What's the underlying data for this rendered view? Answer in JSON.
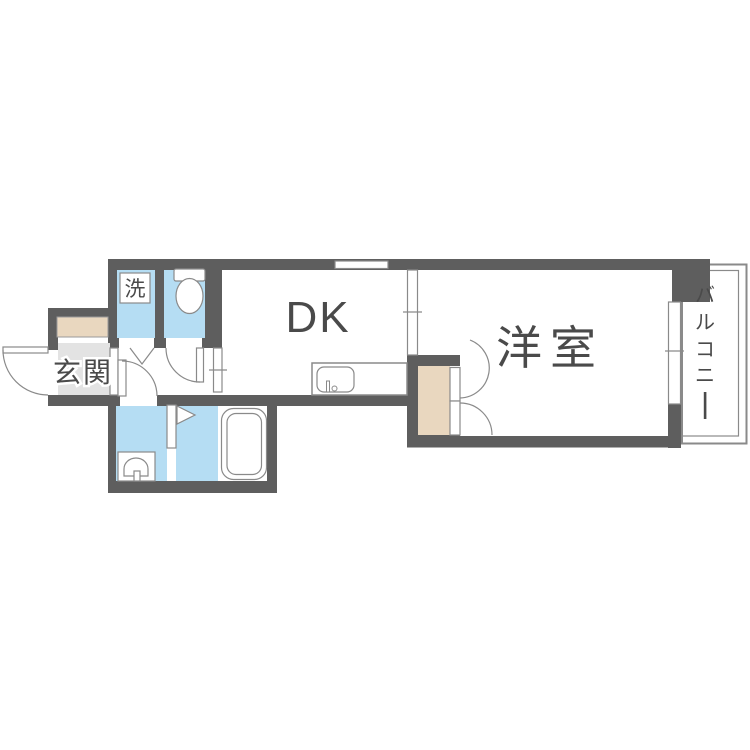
{
  "title": "1DK apartment floor plan",
  "colors": {
    "wall": "#5e5e5e",
    "wet_floor": "#b5ddf3",
    "wood": "#e9d7bf",
    "entrance_floor": "#e3e3e3",
    "fixture_stroke": "#8a8a8a",
    "text": "#4a4a4a"
  },
  "rooms": {
    "entrance": {
      "label": "玄関"
    },
    "laundry": {
      "label": "洗"
    },
    "dk": {
      "label": "DK"
    },
    "western": {
      "label": "洋室"
    },
    "balcony": {
      "label": "バルコニー",
      "chars": [
        "バ",
        "ル",
        "コ",
        "ニ",
        "ー"
      ]
    }
  }
}
